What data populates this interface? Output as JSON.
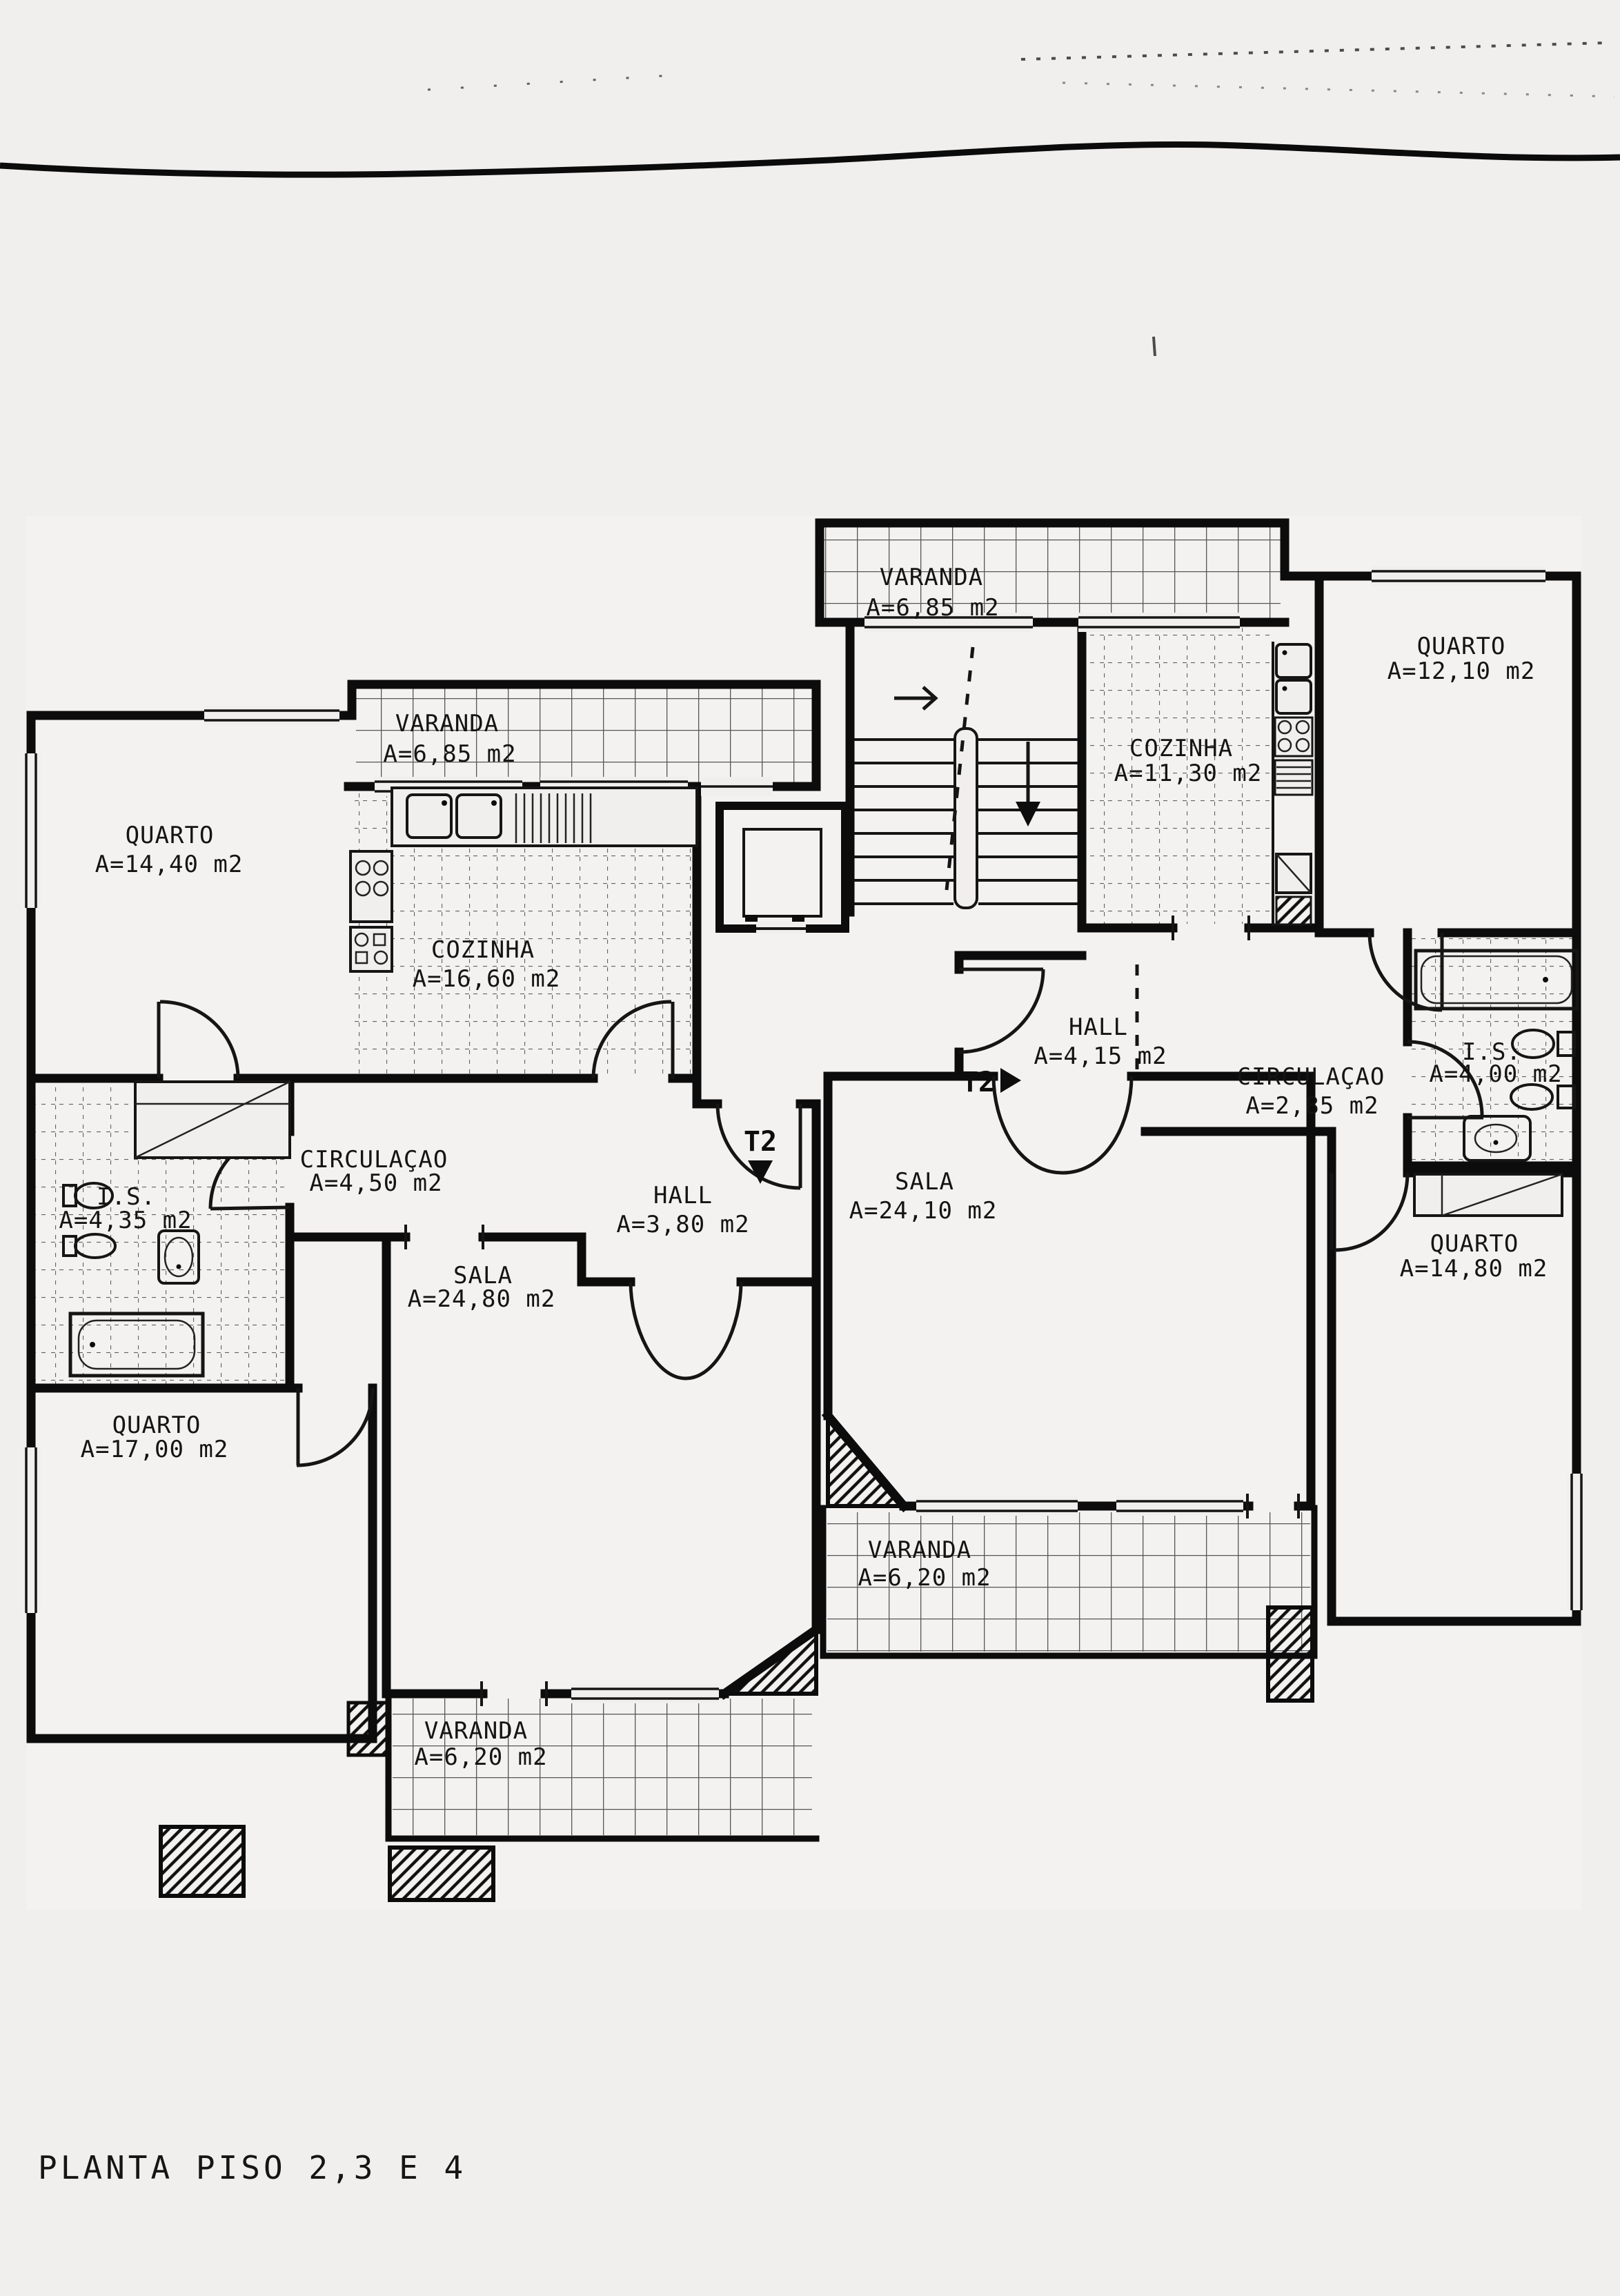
{
  "title": {
    "text": "PLANTA PISO 2,3 E 4"
  },
  "markers": {
    "left_unit": "T2",
    "right_unit": "T2"
  },
  "rooms": {
    "quarto_14_40": {
      "name": "QUARTO",
      "area": "A=14,40 m2"
    },
    "varanda_left": {
      "name": "VARANDA",
      "area": "A=6,85 m2"
    },
    "cozinha_16_60": {
      "name": "COZINHA",
      "area": "A=16,60 m2"
    },
    "is_4_35": {
      "name": "I.S.",
      "area": "A=4,35 m2"
    },
    "circulacao_4_50": {
      "name": "CIRCULAÇAO",
      "area": "A=4,50 m2"
    },
    "hall_3_80": {
      "name": "HALL",
      "area": "A=3,80 m2"
    },
    "quarto_17_00": {
      "name": "QUARTO",
      "area": "A=17,00 m2"
    },
    "sala_24_80": {
      "name": "SALA",
      "area": "A=24,80 m2"
    },
    "varanda_bottom_left": {
      "name": "VARANDA",
      "area": "A=6,20 m2"
    },
    "varanda_top": {
      "name": "VARANDA",
      "area": "A=6,85 m2"
    },
    "cozinha_11_30": {
      "name": "COZINHA",
      "area": "A=11,30 m2"
    },
    "quarto_12_10": {
      "name": "QUARTO",
      "area": "A=12,10 m2"
    },
    "hall_4_15": {
      "name": "HALL",
      "area": "A=4,15 m2"
    },
    "circulacao_2_85": {
      "name": "CIRCULAÇAO",
      "area": "A=2,85 m2"
    },
    "is_4_00": {
      "name": "I.S.",
      "area": "A=4,00 m2"
    },
    "sala_24_10": {
      "name": "SALA",
      "area": "A=24,10 m2"
    },
    "quarto_14_80": {
      "name": "QUARTO",
      "area": "A=14,80 m2"
    },
    "varanda_bottom_center": {
      "name": "VARANDA",
      "area": "A=6,20 m2"
    }
  }
}
